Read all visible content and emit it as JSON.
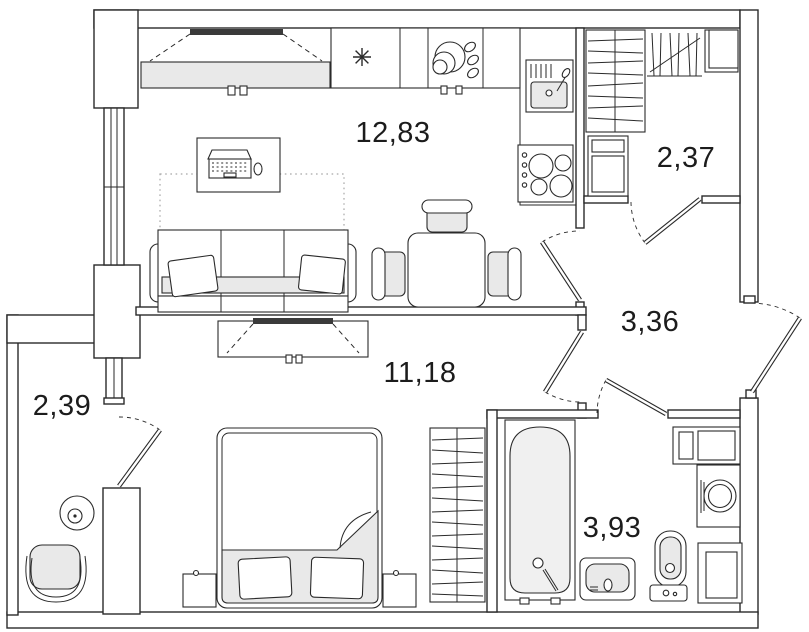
{
  "plan": {
    "type": "apartment-floor-plan",
    "rooms": {
      "living_kitchen": {
        "area": "12,83"
      },
      "closet": {
        "area": "2,37"
      },
      "hallway": {
        "area": "3,36"
      },
      "bedroom": {
        "area": "11,18"
      },
      "balcony": {
        "area": "2,39"
      },
      "bathroom": {
        "area": "3,93"
      }
    },
    "furniture_icons": [
      "tv-stand-living",
      "refrigerator-snowflake-icon",
      "dish-rack-icon",
      "kitchen-sink",
      "stove",
      "desk-with-laptop",
      "rug",
      "sofa",
      "dining-table",
      "dining-chairs",
      "closet-shelves",
      "closet-rail",
      "closet-box",
      "dresser",
      "tv-stand-bedroom",
      "bed",
      "nightstand-left",
      "nightstand-right",
      "wardrobe-bedroom",
      "bathtub",
      "washbasin",
      "toilet",
      "washing-machine",
      "bathroom-shelf",
      "bathroom-cabinet",
      "balcony-table",
      "balcony-chair"
    ],
    "colors": {
      "background": "#ffffff",
      "line": "#2a2a2a",
      "light_fill": "#e9e9e9",
      "tv_bar": "#3a3a3a"
    }
  }
}
